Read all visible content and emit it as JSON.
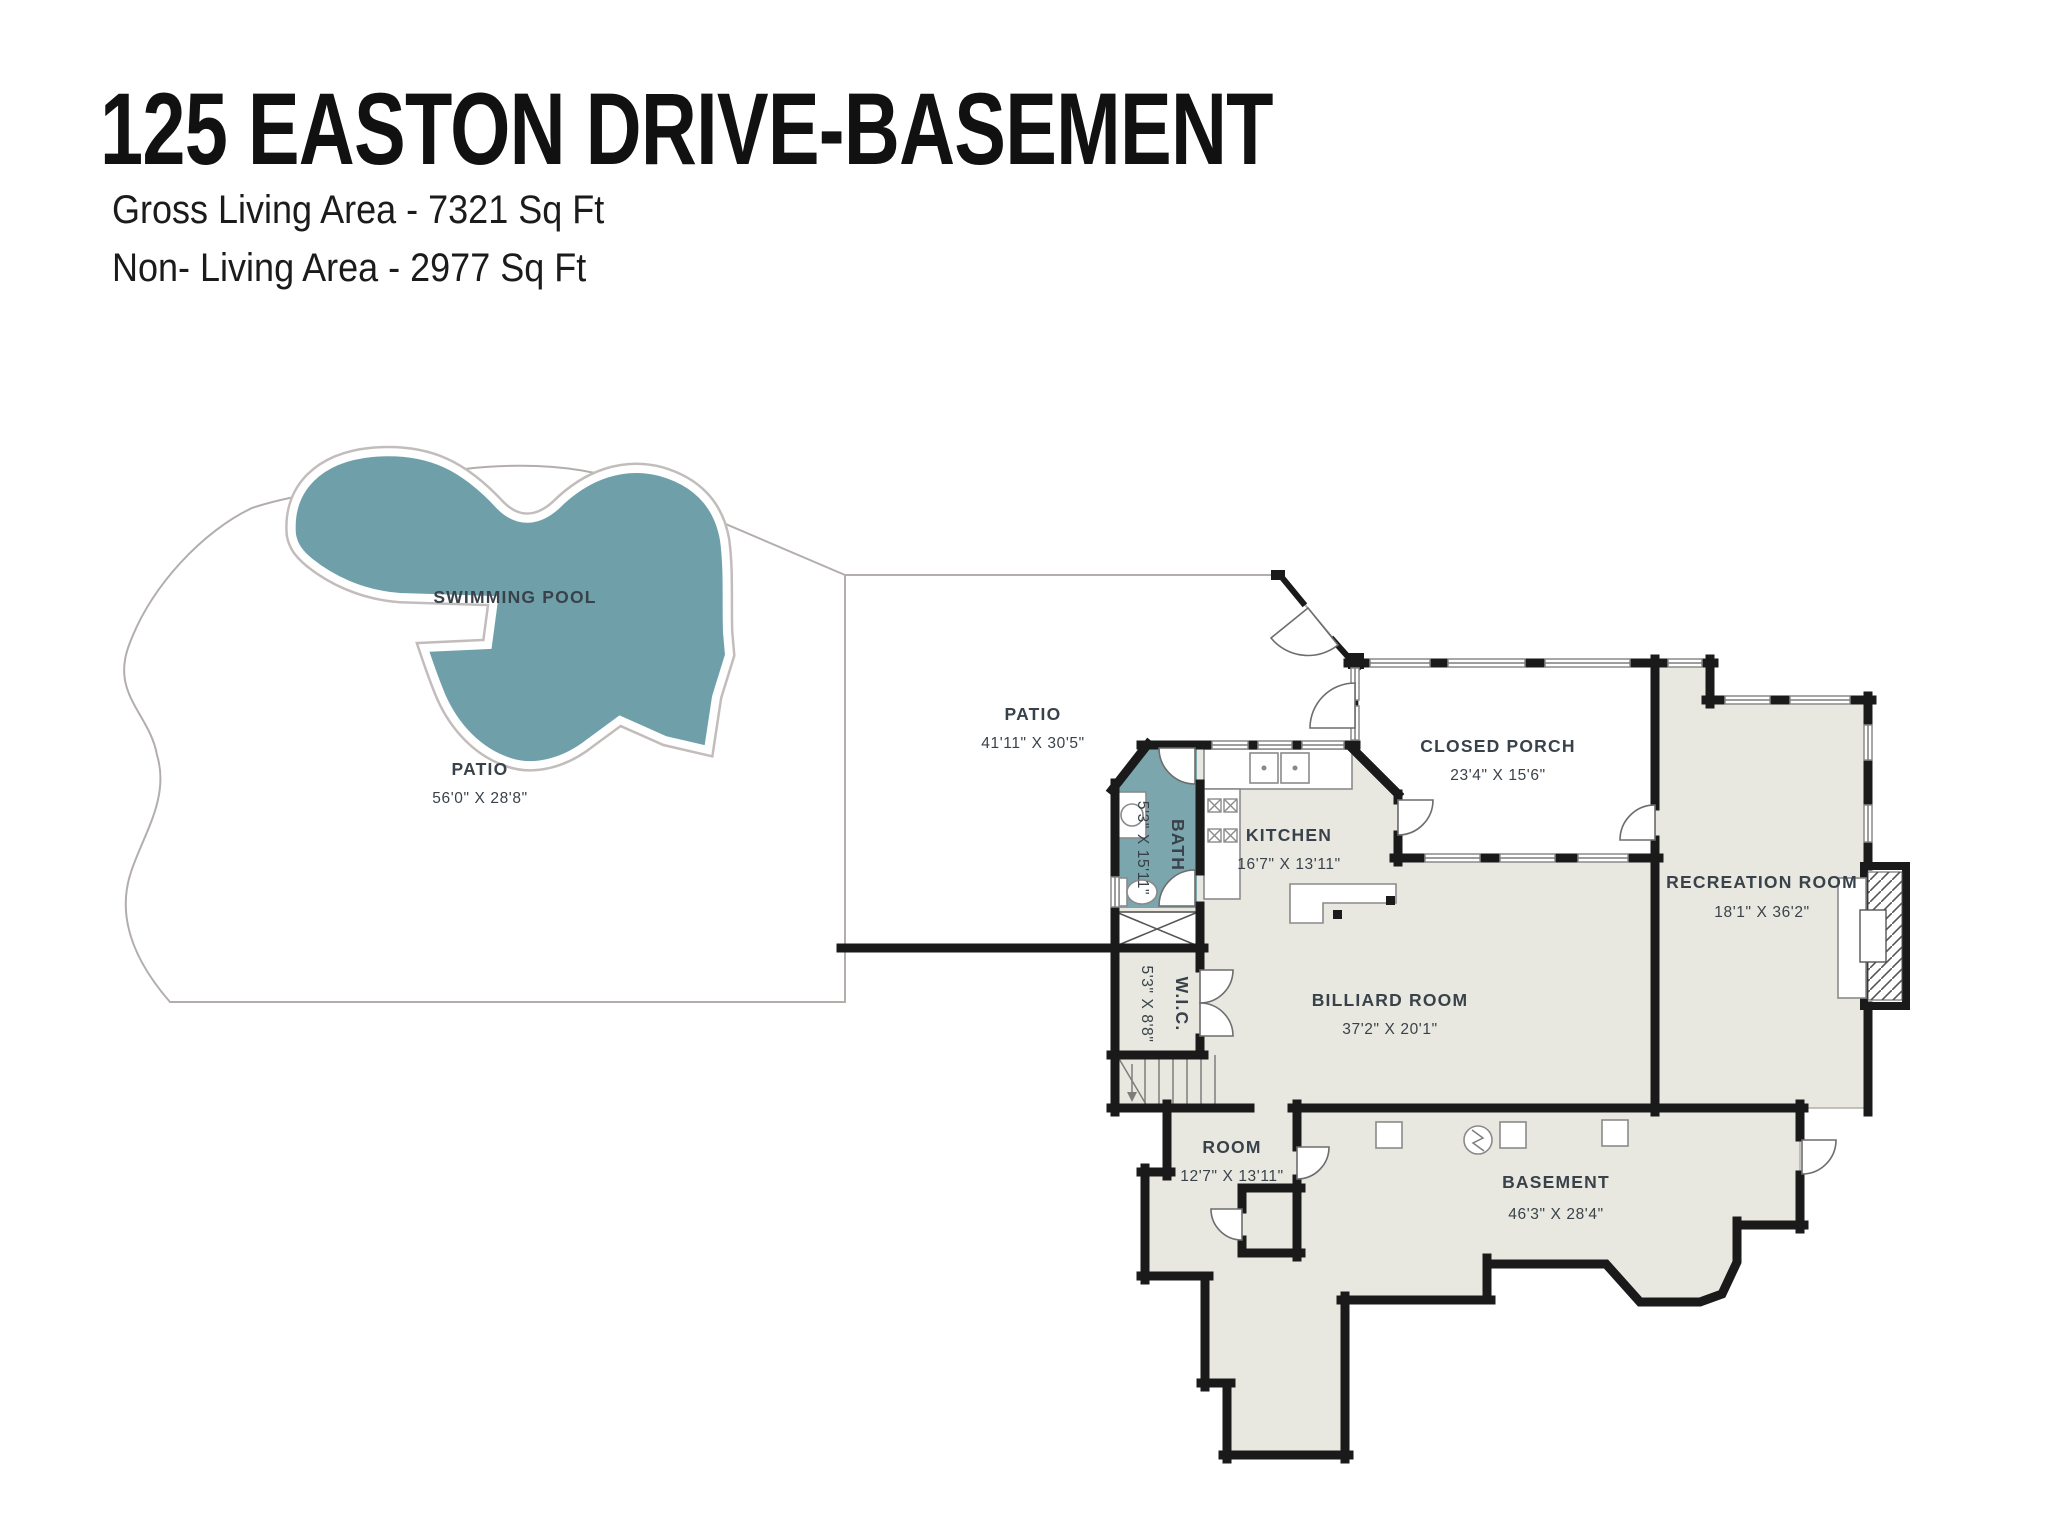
{
  "header": {
    "title": "125 EASTON DRIVE-BASEMENT",
    "subtitle_gross": "Gross Living Area - 7321 Sq Ft",
    "subtitle_non_living": "Non- Living Area - 2977 Sq Ft"
  },
  "colors": {
    "patio_pink": "#ecc6cc",
    "pool_teal": "#6fa0aa",
    "bath_teal": "#7ba6ae",
    "interior_gray": "#e9e8e0",
    "wall_black": "#1a1a1a",
    "label_text": "#39424a"
  },
  "rooms": [
    {
      "id": "swimming-pool",
      "name": "SWIMMING POOL",
      "dimensions": ""
    },
    {
      "id": "patio-left",
      "name": "PATIO",
      "dimensions": "56'0\" X 28'8\""
    },
    {
      "id": "patio-main",
      "name": "PATIO",
      "dimensions": "41'11\" X 30'5\""
    },
    {
      "id": "closed-porch",
      "name": "CLOSED PORCH",
      "dimensions": "23'4\" X 15'6\""
    },
    {
      "id": "kitchen",
      "name": "KITCHEN",
      "dimensions": "16'7\" X 13'11\""
    },
    {
      "id": "bath",
      "name": "BATH",
      "dimensions": "5'3\" X 15'11\""
    },
    {
      "id": "wic",
      "name": "W.I.C.",
      "dimensions": "5'3\" X 8'8\""
    },
    {
      "id": "billiard-room",
      "name": "BILLIARD ROOM",
      "dimensions": "37'2\" X 20'1\""
    },
    {
      "id": "recreation-room",
      "name": "RECREATION ROOM",
      "dimensions": "18'1\" X 36'2\""
    },
    {
      "id": "room",
      "name": "ROOM",
      "dimensions": "12'7\" X 13'11\""
    },
    {
      "id": "basement",
      "name": "BASEMENT",
      "dimensions": "46'3\" X 28'4\""
    }
  ]
}
